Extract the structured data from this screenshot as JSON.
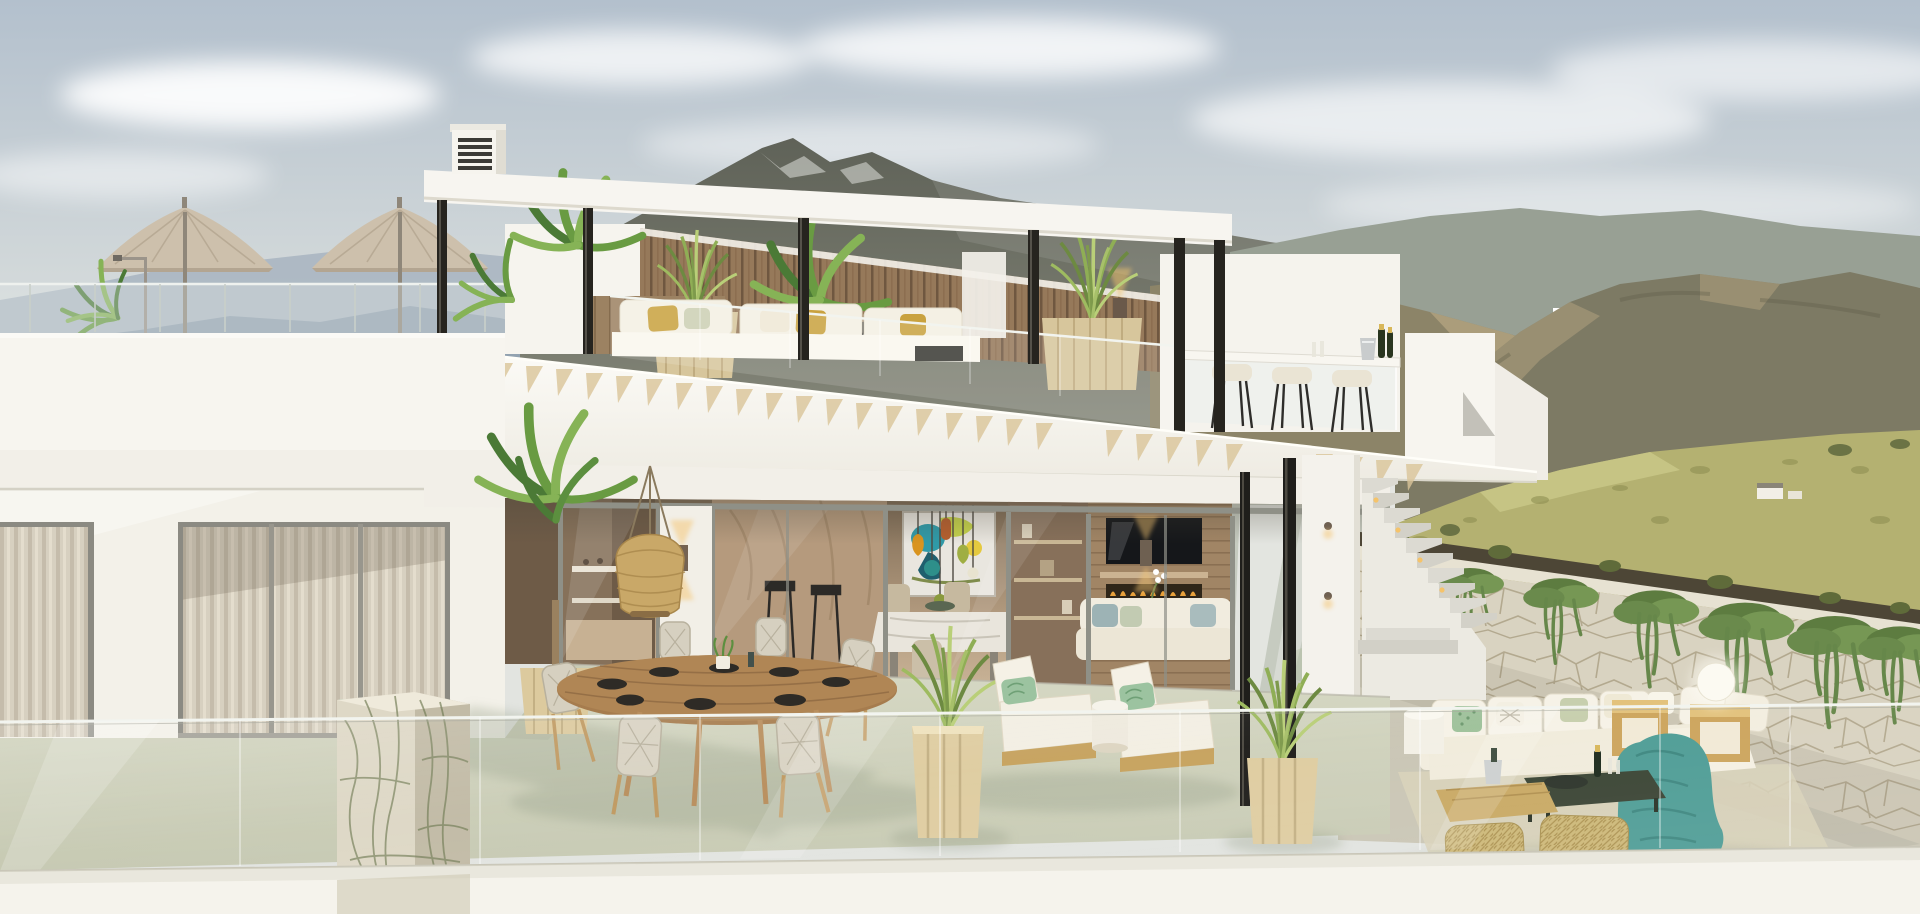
{
  "meta": {
    "title": "Modern villa with roof terrace - architectural rendering",
    "description": "Two-storey white modern villa with rooftop pergola terrace, glass balustrades, outdoor dining and lounge furniture, set against hazy mountains"
  },
  "palette": {
    "sky_top": "#b5c2ce",
    "sky_horizon": "#e2e4e0",
    "cloud": "#ffffff",
    "mountain_far_left": "#9fadba",
    "mountain_mid_left": "#8fa0ae",
    "mountain_peak": "#5f6258",
    "mountain_right": "#8c8468",
    "mountain_sunlit": "#b5a582",
    "mountain_right_near": "#7d7a64",
    "hill_grass": "#b4b171",
    "bush_green": "#5f6b3a",
    "villa_white": "#f7f5ef",
    "villa_shadow": "#e4e1d8",
    "slab_soffit": "#d9d6ca",
    "rafter_wood": "#d8c49c",
    "wood_slat_wall": "#96795a",
    "steel_column": "#26241f",
    "glass_tint": "#dfe6e6",
    "curtain": "#d9d2c2",
    "interior_warm": "#b49c80",
    "interior_dark": "#6e5b47",
    "terrace_floor": "#ccd0ba",
    "deck_floor": "#cac6b5",
    "stone_marble": "#ded8c6",
    "stone_vein": "#6f7a52",
    "stone_wall": "#d9d3c1",
    "soil": "#4d4636",
    "ivy_green": "#66874a",
    "palm_green": "#699b42",
    "grass_planter": "#8fae55",
    "planter_wood": "#dcca9e",
    "cushion_white": "#f5f1e6",
    "pillow_mustard": "#c9a23f",
    "pillow_green": "#9cc3a0",
    "pillow_blue": "#9db3b5",
    "blanket_teal": "#4f9d96",
    "pouf_wicker": "#cdb878",
    "table_wood": "#a67c4e",
    "umbrella_canvas": "#cdc0ac",
    "rattan_lamp": "#c9a868",
    "pendant_amber": "#d9941f",
    "pendant_teal": "#2e8f8a",
    "pendant_blue": "#7fb3d6",
    "pendant_olive": "#9fae43",
    "flame_orange": "#e8a13c",
    "sconce_glow": "#f4c572",
    "champagne_green": "#29351f"
  },
  "scene": {
    "sky": {
      "label": "hazy blue morning sky with soft clouds"
    },
    "mountains": {
      "left": "hazy blue ridges",
      "center": "dark rocky peak behind pergola",
      "right": "sunlit brown sierra with tiny white houses"
    },
    "hillside": {
      "label": "grassy slope with shrubs and distant farmhouse"
    },
    "roof_terrace": {
      "items": [
        "pergola with wood rafters",
        "black steel columns",
        "chimney vent",
        "two canvas parasols",
        "palm plants",
        "bbq grill",
        "wood slat wall",
        "wall sconce",
        "black vases",
        "white lounge sofa",
        "mustard pillows",
        "grass planters",
        "glass railing",
        "bar counter with glass base",
        "three bar stools",
        "champagne bucket and bottles"
      ]
    },
    "main_level": {
      "items": [
        "sliding glass doors",
        "sheer curtains",
        "rattan pendant lamp",
        "wall sconces",
        "abstract wall art",
        "coloured glass pendant cluster",
        "marble dining table",
        "beige chairs",
        "shelving",
        "tv wall",
        "linear fireplace",
        "white interior sofa",
        "orchid"
      ]
    },
    "terrace": {
      "items": [
        "green-veined marble pillar",
        "glass fin",
        "potted palm",
        "round wood dining table set for six",
        "wicker dining chairs",
        "two white chaise lounges with green pillows",
        "wood cube planters with grasses",
        "black steel columns",
        "glass balustrade"
      ]
    },
    "right_deck": {
      "items": [
        "white outdoor corner sofa",
        "patterned pillows",
        "teal knit blanket",
        "wood cube tables",
        "dark coffee table",
        "champagne set",
        "two wicker poufs",
        "globe lamp",
        "area rug",
        "staircase with step lights",
        "stone retaining wall with trailing ivy"
      ]
    }
  }
}
